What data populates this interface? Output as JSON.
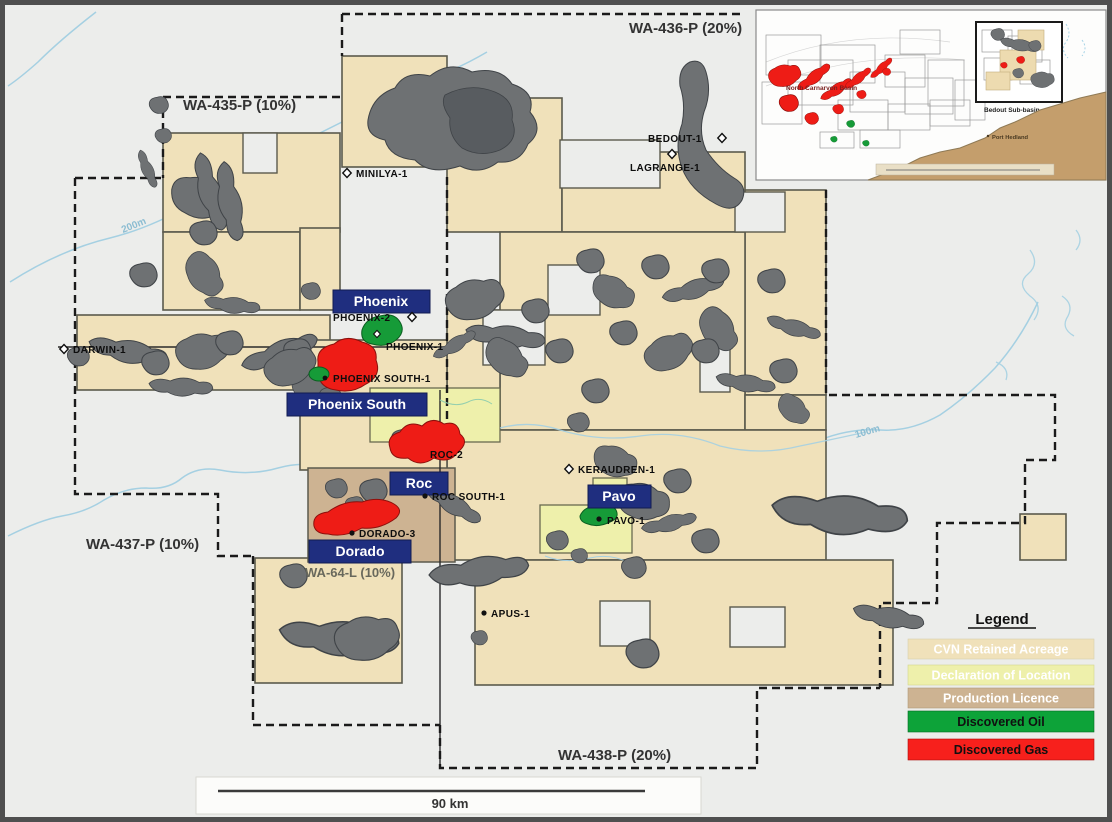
{
  "map": {
    "permits": [
      {
        "label": "WA-435-P (10%)"
      },
      {
        "label": "WA-436-P (20%)"
      },
      {
        "label": "WA-437-P (10%)"
      },
      {
        "label": "WA-438-P (20%)"
      },
      {
        "label": "WA-64-L (10%)"
      }
    ],
    "fields": [
      {
        "label": "Phoenix"
      },
      {
        "label": "Phoenix South"
      },
      {
        "label": "Roc"
      },
      {
        "label": "Dorado"
      },
      {
        "label": "Pavo"
      }
    ],
    "wells": [
      {
        "name": "MINILYA-1",
        "marker": "diamond"
      },
      {
        "name": "BEDOUT-1",
        "marker": "diamond"
      },
      {
        "name": "LAGRANGE-1",
        "marker": "diamond"
      },
      {
        "name": "DARWIN-1",
        "marker": "diamond"
      },
      {
        "name": "PHOENIX-2",
        "marker": "diamond"
      },
      {
        "name": "PHOENIX-1",
        "marker": "diamond"
      },
      {
        "name": "PHOENIX SOUTH-1",
        "marker": "dot"
      },
      {
        "name": "ROC-2",
        "marker": "dot"
      },
      {
        "name": "ROC SOUTH-1",
        "marker": "dot"
      },
      {
        "name": "DORADO-3",
        "marker": "dot"
      },
      {
        "name": "KERAUDREN-1",
        "marker": "diamond"
      },
      {
        "name": "PAVO-1",
        "marker": "dot"
      },
      {
        "name": "APUS-1",
        "marker": "dot"
      }
    ],
    "contours": [
      {
        "label": "200m"
      },
      {
        "label": "100m"
      }
    ],
    "scale_bar": {
      "label": "90 km"
    },
    "inset": {
      "basin_label": "North Carnarvon Basin",
      "box_label": "Bedout Sub-basin",
      "coast_label": "Port Hedland"
    },
    "legend": {
      "title": "Legend",
      "items": [
        {
          "label": "CVN Retained Acreage",
          "color": "#f0e1ba",
          "text_color": "#ffffff"
        },
        {
          "label": "Declaration of Location",
          "color": "#eef0ab",
          "text_color": "#ffffff"
        },
        {
          "label": "Production Licence",
          "color": "#cdb392",
          "text_color": "#ffffff"
        },
        {
          "label": "Discovered Oil",
          "color": "#0da339",
          "text_color": "#101010"
        },
        {
          "label": "Discovered Gas",
          "color": "#f7201c",
          "text_color": "#101010"
        }
      ]
    },
    "colors": {
      "sea": "#ecedeb",
      "retained_acreage": "#f0e1ba",
      "declaration_of_location": "#eef0ab",
      "production_licence": "#cdb392",
      "discovered_oil": "#169b38",
      "discovered_gas": "#ee1c16",
      "field_label_box": "#1f2e7f"
    }
  }
}
